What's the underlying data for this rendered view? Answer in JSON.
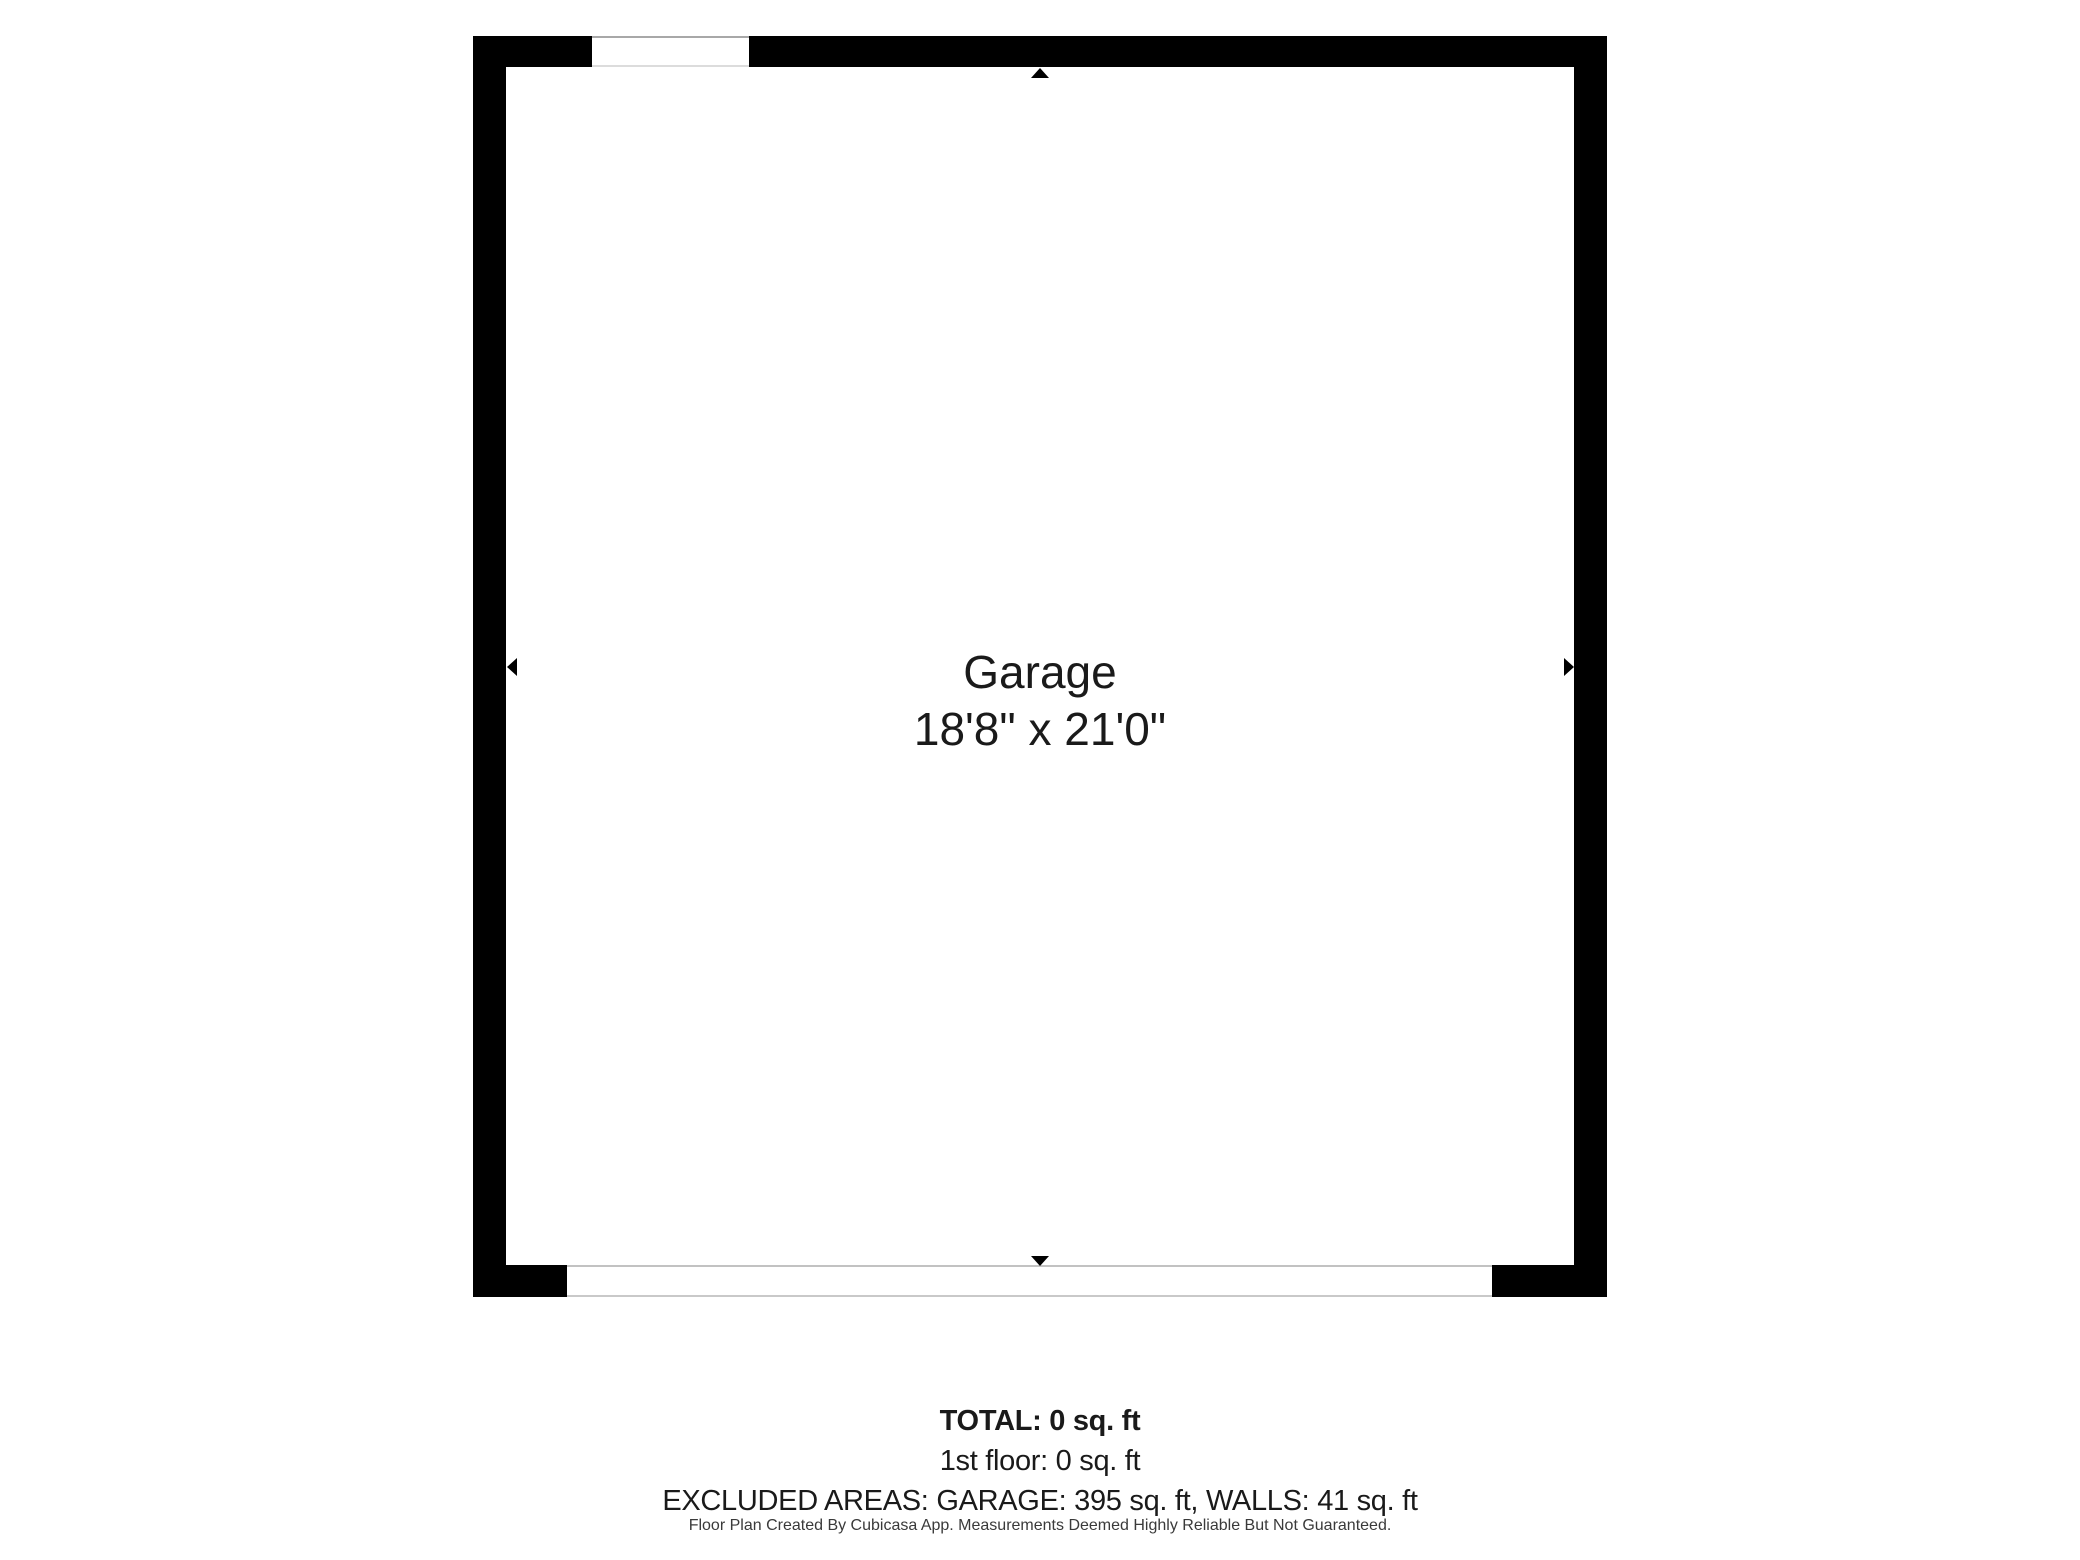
{
  "floorplan": {
    "room": {
      "label": "Garage",
      "dimensions": "18'8\" x 21'0\""
    },
    "colors": {
      "wall": "#000000",
      "opening_outline_dark": "#a8a8a8",
      "opening_outline_light": "#c9c9c9",
      "text": "#1a1a1a"
    },
    "icons": [
      "arrow-up-icon",
      "arrow-down-icon",
      "arrow-left-icon",
      "arrow-right-icon"
    ]
  },
  "summary": {
    "total": "TOTAL: 0 sq. ft",
    "first_floor": "1st floor: 0 sq. ft",
    "excluded_areas": "EXCLUDED AREAS: GARAGE: 395 sq. ft, WALLS: 41 sq. ft"
  },
  "footer": {
    "disclaimer": "Floor Plan Created By Cubicasa App. Measurements Deemed Highly Reliable But Not Guaranteed."
  }
}
